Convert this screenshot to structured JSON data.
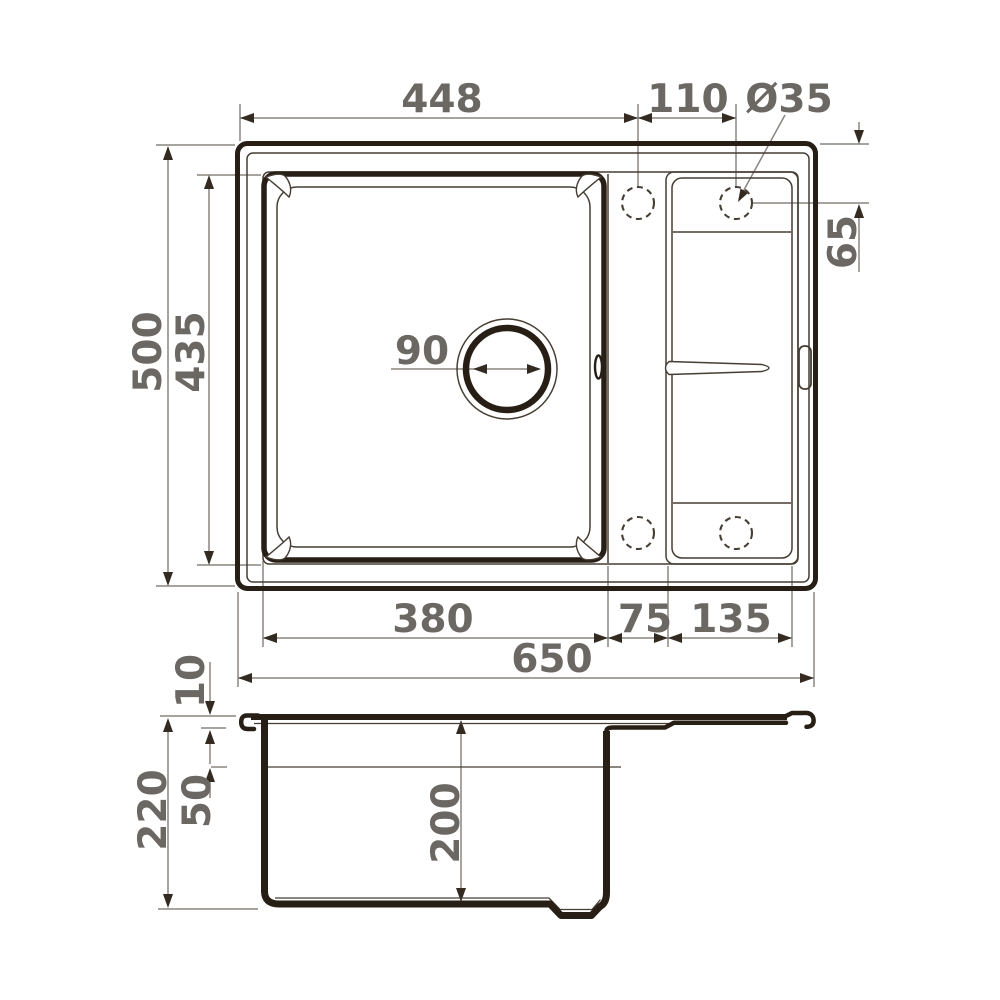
{
  "drawing": {
    "colors": {
      "line": "#271e15",
      "thin_line": "#463d33",
      "dimension_line": "#8a8580",
      "arrow": "#332b22",
      "label_text": "#6b6763",
      "background": "#ffffff"
    },
    "top_view": {
      "width_to_hole_448": "448",
      "hole_spacing_110": "110",
      "hole_diameter_35": "Ø35",
      "hole_edge_offset_65": "65",
      "overall_depth_500": "500",
      "bowl_outer_depth_435": "435",
      "drain_diameter_90": "90",
      "bowl_width_380": "380",
      "divider_width_75": "75",
      "wing_width_135": "135",
      "overall_width_650": "650"
    },
    "section_view": {
      "flange_thickness_10": "10",
      "overall_height_220": "220",
      "rim_drop_50": "50",
      "bowl_depth_200": "200"
    }
  }
}
